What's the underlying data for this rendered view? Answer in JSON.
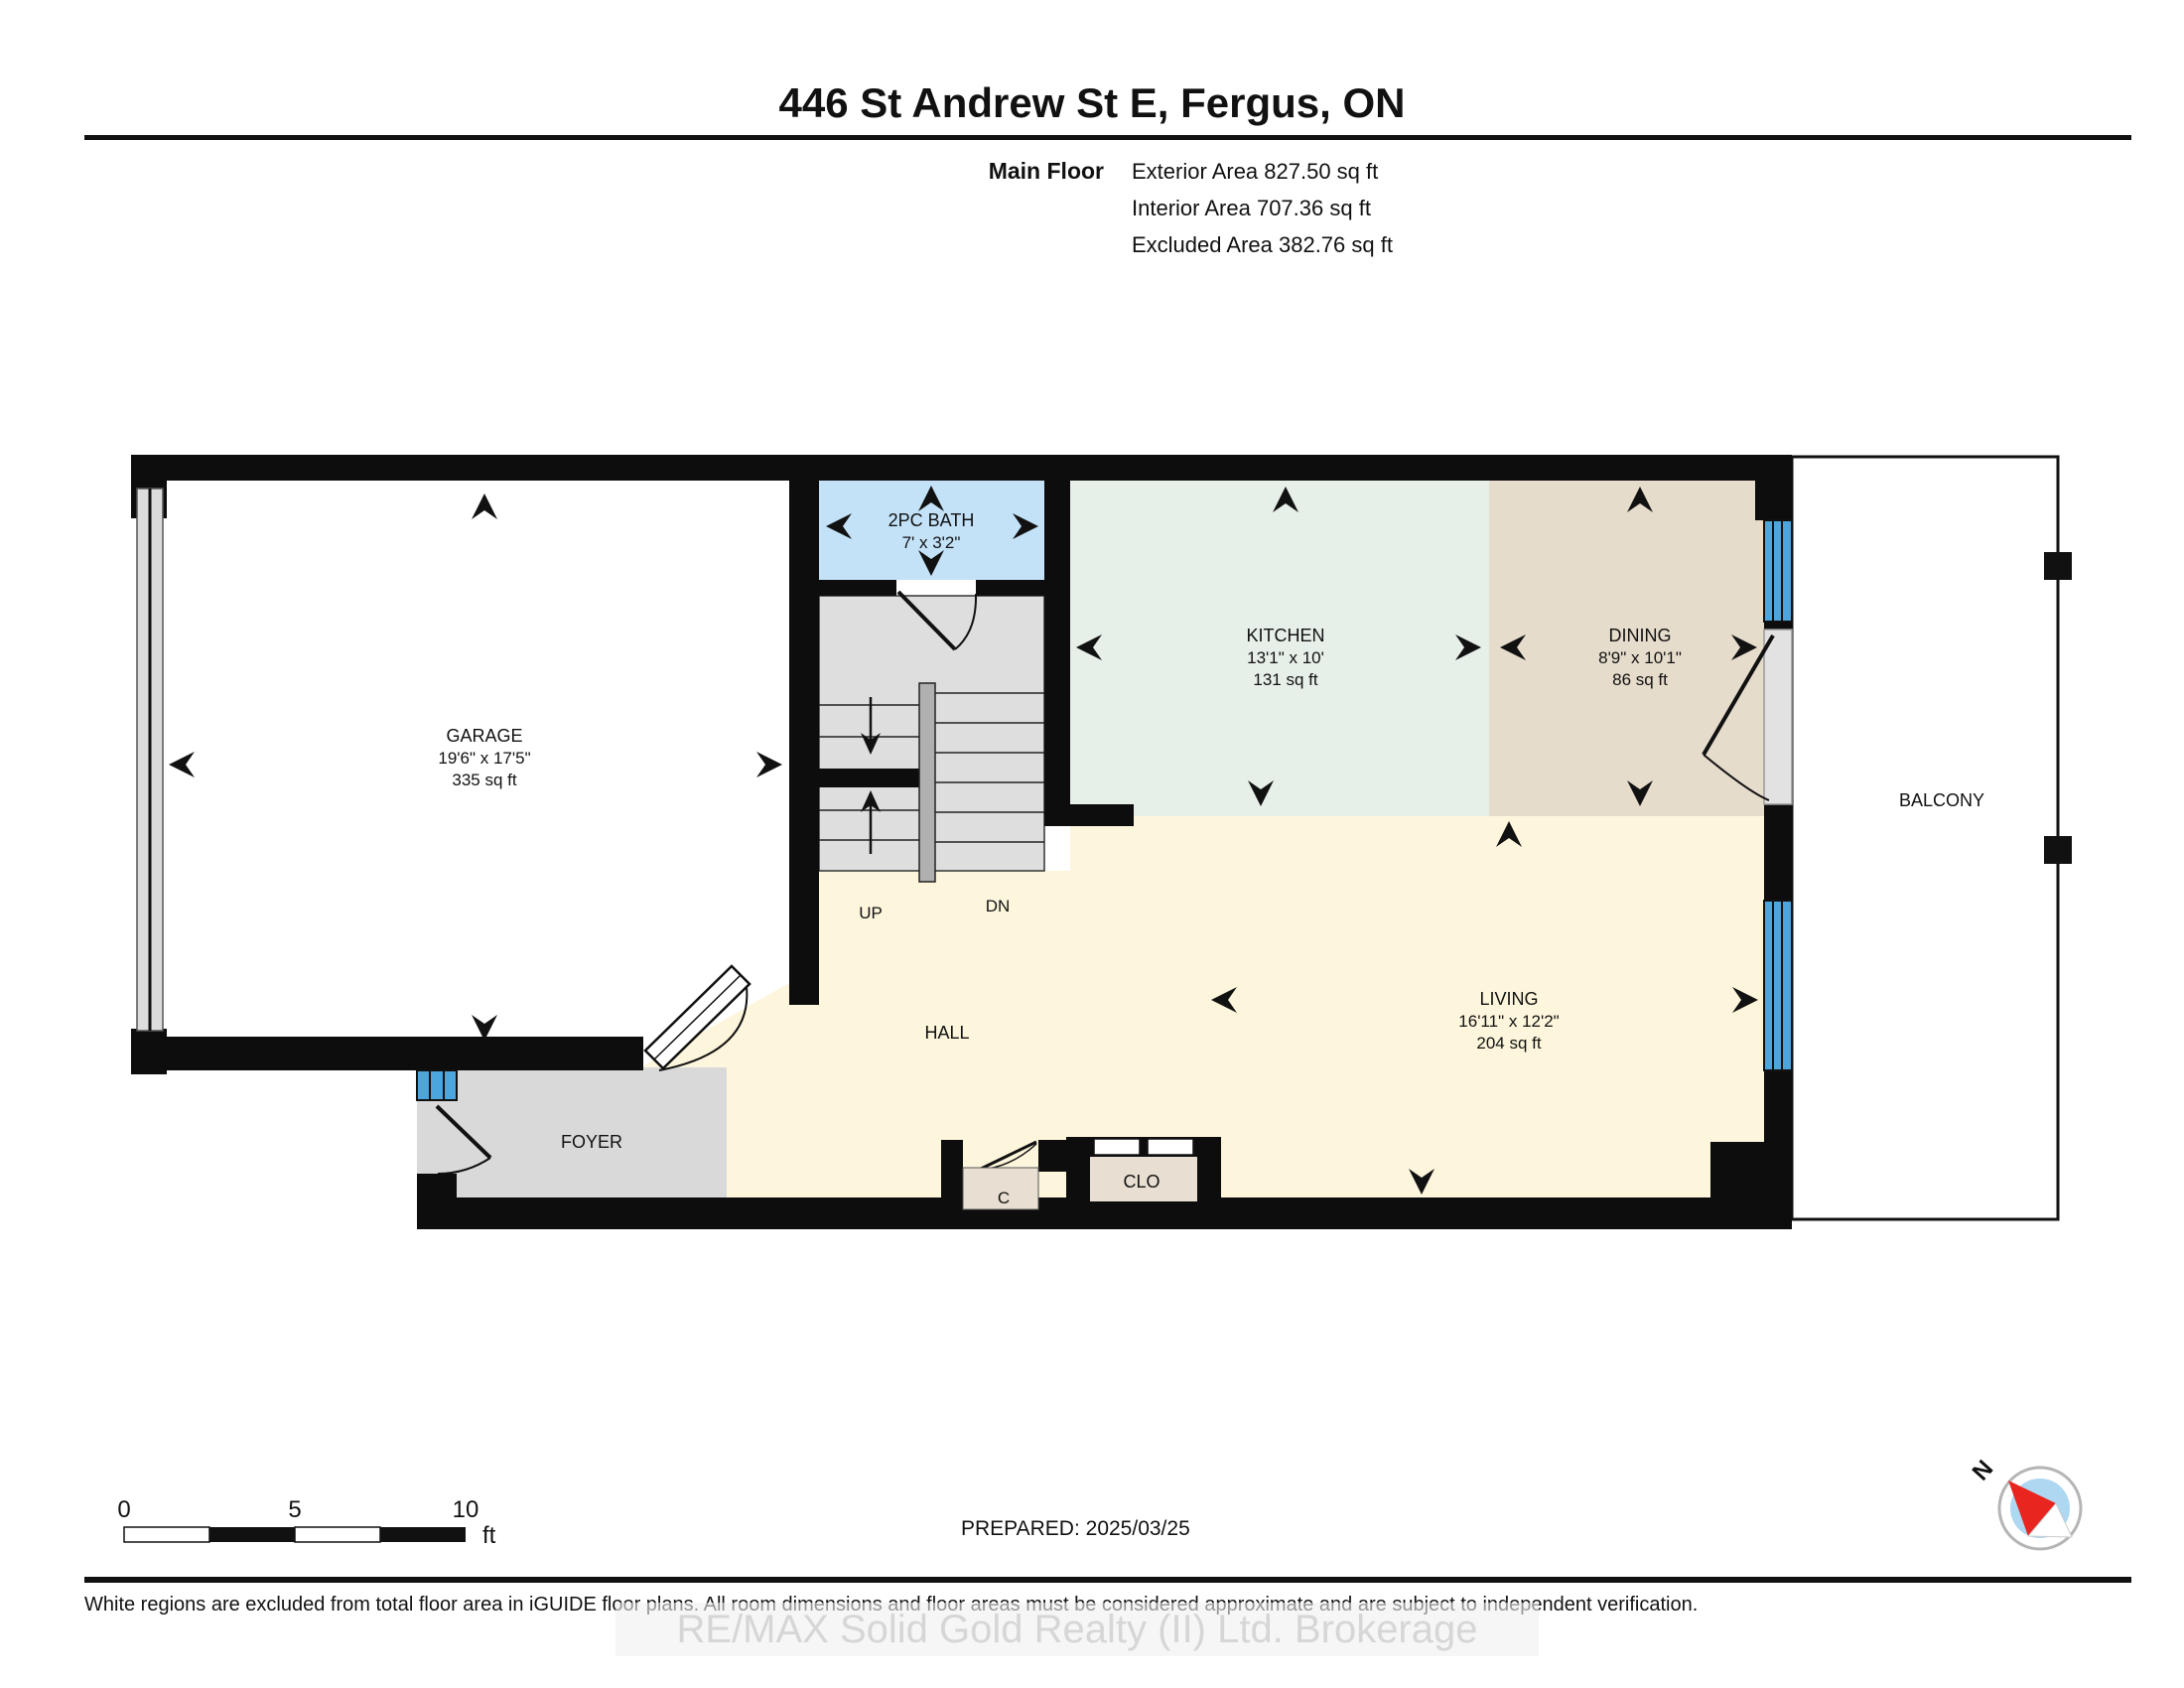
{
  "header": {
    "title": "446 St Andrew St E, Fergus, ON",
    "floor_label": "Main Floor",
    "area_lines": {
      "exterior": "Exterior Area 827.50 sq ft",
      "interior": "Interior Area 707.36 sq ft",
      "excluded": "Excluded Area 382.76 sq ft"
    }
  },
  "rooms": {
    "garage": {
      "name": "GARAGE",
      "dims": "19'6\" x 17'5\"",
      "area": "335 sq ft"
    },
    "bath": {
      "name": "2PC BATH",
      "dims": "7' x 3'2\""
    },
    "kitchen": {
      "name": "KITCHEN",
      "dims": "13'1\" x 10'",
      "area": "131 sq ft"
    },
    "dining": {
      "name": "DINING",
      "dims": "8'9\" x 10'1\"",
      "area": "86 sq ft"
    },
    "living": {
      "name": "LIVING",
      "dims": "16'11\" x 12'2\"",
      "area": "204 sq ft"
    },
    "hall": {
      "name": "HALL"
    },
    "foyer": {
      "name": "FOYER"
    },
    "closet": {
      "name": "CLO"
    },
    "closet_small": {
      "name": "C"
    },
    "balcony": {
      "name": "BALCONY"
    },
    "stairs": {
      "up": "UP",
      "down": "DN"
    }
  },
  "scale_bar": {
    "tick_0": "0",
    "tick_5": "5",
    "tick_10": "10",
    "unit": "ft"
  },
  "compass": {
    "north_label": "N"
  },
  "footer": {
    "prepared": "PREPARED: 2025/03/25",
    "disclaimer": "White regions are excluded from total floor area in iGUIDE floor plans. All room dimensions and floor areas must be considered approximate and are subject to independent verification.",
    "watermark": "RE/MAX Solid Gold Realty (II) Ltd. Brokerage"
  },
  "colors": {
    "wall": "#0d0d0d",
    "window": "#4da5dd",
    "bath_fill": "#c3e2f8",
    "kitchen_fill": "#e7efe9",
    "dining_fill": "#e6dccc",
    "living_fill": "#fdf6dc",
    "stair_fill": "#dedede",
    "foyer_fill": "#d9d9d9",
    "closet_fill": "#e8dfd2",
    "compass_inner": "#aed7f2",
    "compass_needle": "#e8251f"
  }
}
